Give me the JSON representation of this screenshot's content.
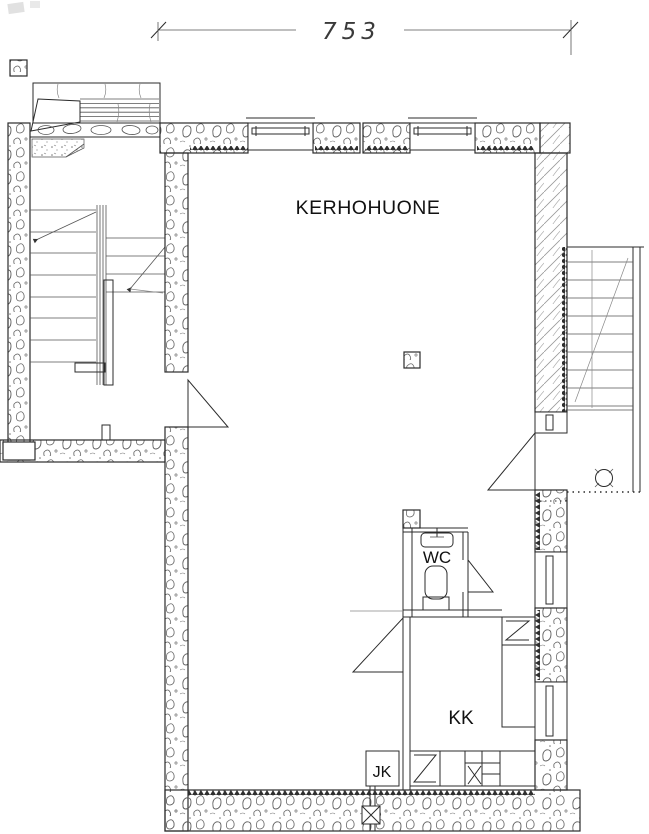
{
  "dimension": {
    "width_label": "753"
  },
  "labels": {
    "main_room": "KERHOHUONE",
    "wc": "WC",
    "kitchenette": "KK",
    "fridge": "JK"
  },
  "colors": {
    "ink": "#2b2b2b",
    "texture": "#5f5f5f",
    "paper": "#ffffff"
  },
  "symbols": [
    "dimension-line",
    "stairs-up-arrow",
    "door-swing",
    "window",
    "column",
    "toilet-icon",
    "sink-icon",
    "stove-icon",
    "cabinet-zigzag-icon",
    "fridge-box",
    "floor-drain-icon",
    "insulation-sawtooth",
    "stone-wall-hatch"
  ]
}
